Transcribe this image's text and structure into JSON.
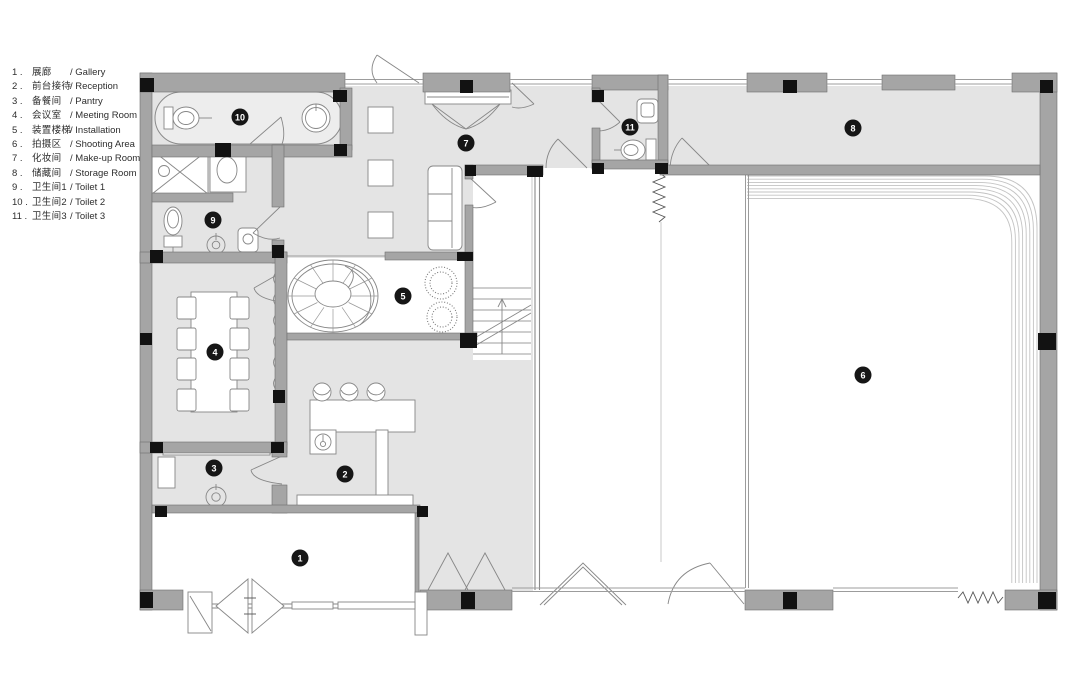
{
  "legend": {
    "items": [
      {
        "num": "1 .",
        "zh": "展廊",
        "en": "/ Gallery"
      },
      {
        "num": "2 .",
        "zh": "前台接待",
        "en": "/ Reception"
      },
      {
        "num": "3 .",
        "zh": "备餐间",
        "en": "/ Pantry"
      },
      {
        "num": "4 .",
        "zh": "会议室",
        "en": "/ Meeting Room"
      },
      {
        "num": "5 .",
        "zh": "装置楼梯",
        "en": "/ Installation"
      },
      {
        "num": "6 .",
        "zh": "拍摄区",
        "en": "/ Shooting Area"
      },
      {
        "num": "7 .",
        "zh": "化妆间",
        "en": "/ Make-up Room"
      },
      {
        "num": "8 .",
        "zh": "储藏间",
        "en": "/ Storage Room"
      },
      {
        "num": "9 .",
        "zh": "卫生间1",
        "en": "/ Toilet 1"
      },
      {
        "num": "10 .",
        "zh": "卫生间2",
        "en": "/ Toilet 2"
      },
      {
        "num": "11 .",
        "zh": "卫生间3",
        "en": "/ Toilet 3"
      }
    ]
  },
  "plan": {
    "badges": [
      "1",
      "2",
      "3",
      "4",
      "5",
      "6",
      "7",
      "8",
      "9",
      "10",
      "11"
    ],
    "colors": {
      "floor": "#e4e4e4",
      "wall": "#a5a5a5",
      "column": "#121212",
      "badge": "#161616",
      "white_room": "#ffffff"
    }
  }
}
